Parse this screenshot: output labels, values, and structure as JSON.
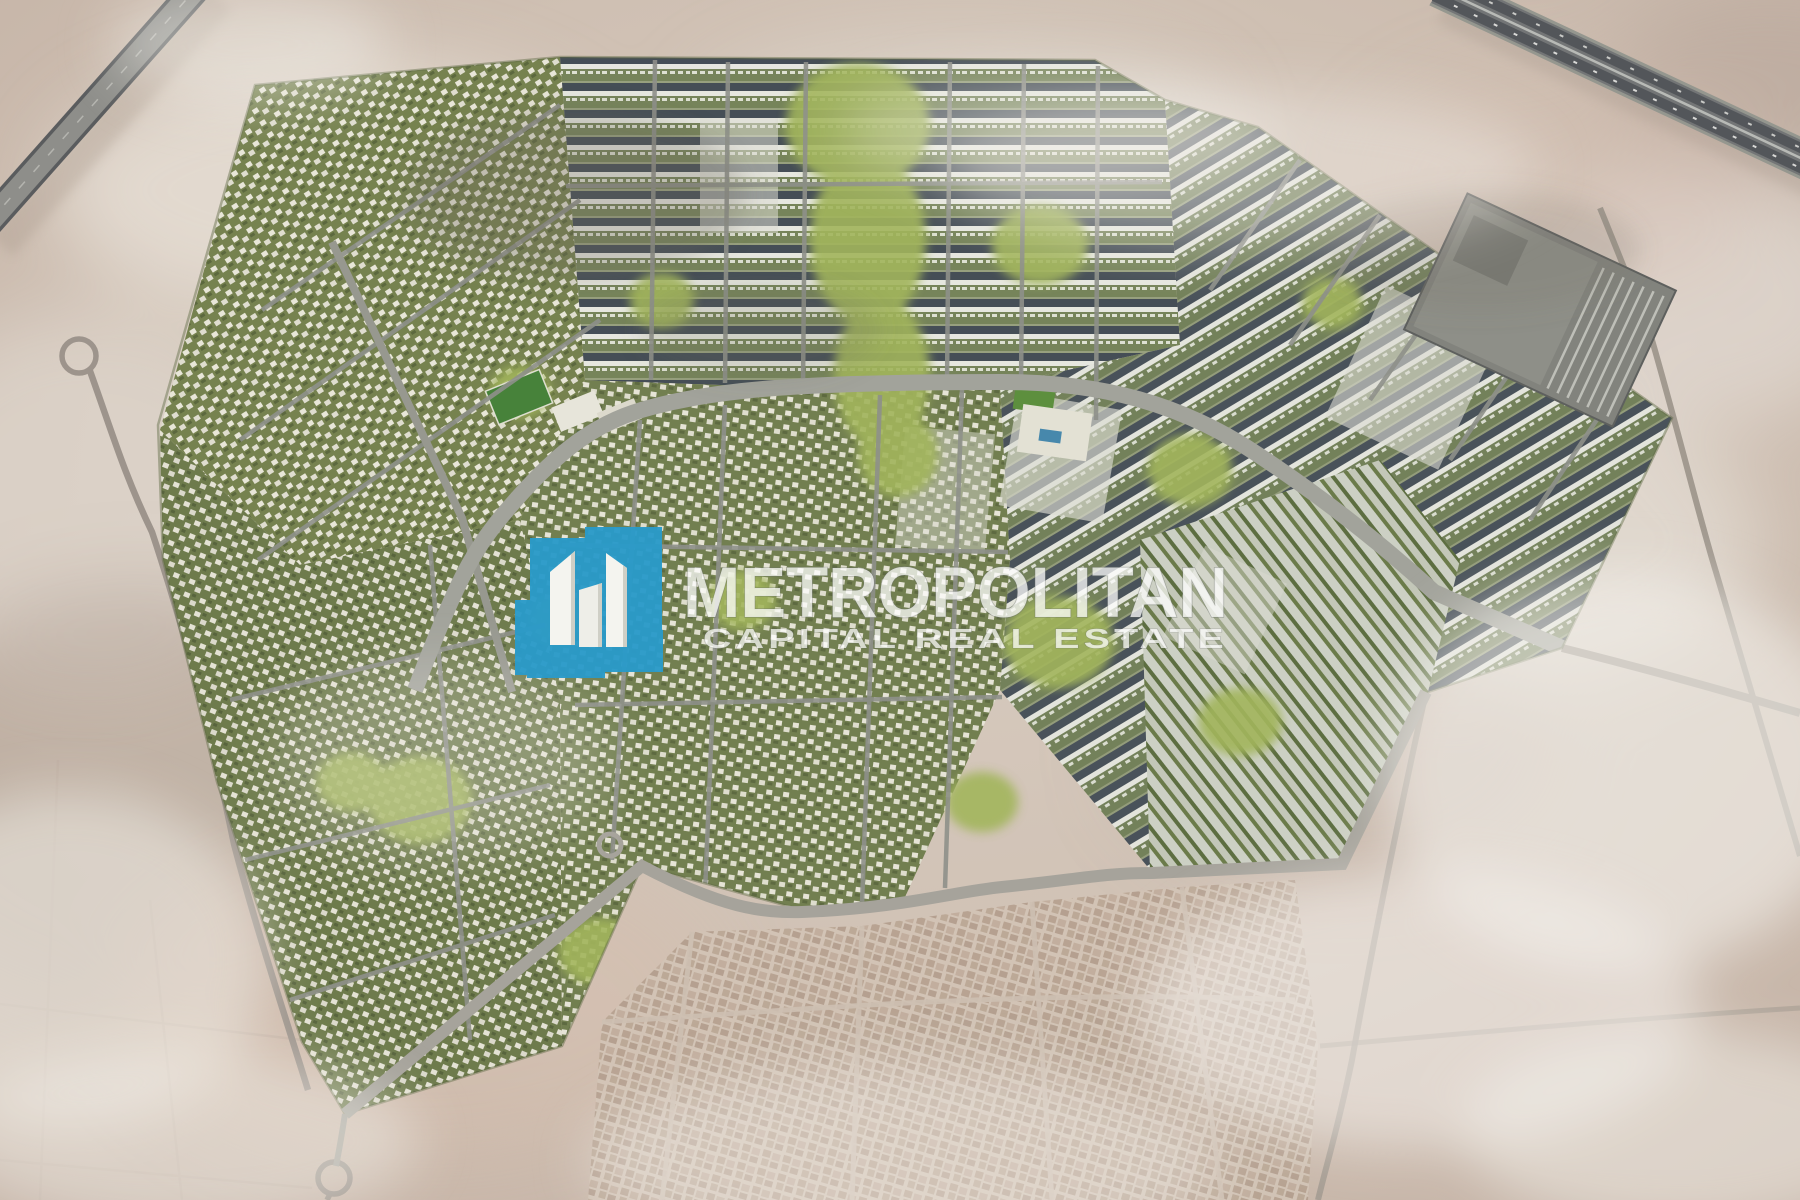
{
  "page": {
    "title": "Community Masterplan Aerial View"
  },
  "watermark": {
    "title": "METROPOLITAN",
    "subtitle": "CAPITAL REAL ESTATE",
    "logo_icon": "towers-logo-icon",
    "logo_color": "#2a9bc9"
  },
  "scene": {
    "type": "aerial-masterplan-render",
    "description": "Aerial 3D masterplan rendering of a large residential community surrounded by desert, with highways at the top corners, a retail center at the north-east, a linear central park, perimeter roads with roundabouts and an existing low-rise neighborhood at the bottom.",
    "palette": {
      "desert": "#cfc0b3",
      "desert_light": "#e6dfd7",
      "development_green": "#7c8859",
      "park_green": "#a2b55c",
      "road_gray": "#a2a39b",
      "highway_gray": "#737576",
      "roof_dark": "#49525a",
      "building_white": "#e9eae2",
      "existing_blocks": "#bcab9b"
    },
    "features": [
      {
        "name": "northwest-highway"
      },
      {
        "name": "northeast-highway"
      },
      {
        "name": "residential-development"
      },
      {
        "name": "central-park-spine"
      },
      {
        "name": "retail-center"
      },
      {
        "name": "greenhouse-rows"
      },
      {
        "name": "existing-neighborhood"
      },
      {
        "name": "perimeter-road-roundabout"
      },
      {
        "name": "desert-surroundings"
      }
    ]
  }
}
